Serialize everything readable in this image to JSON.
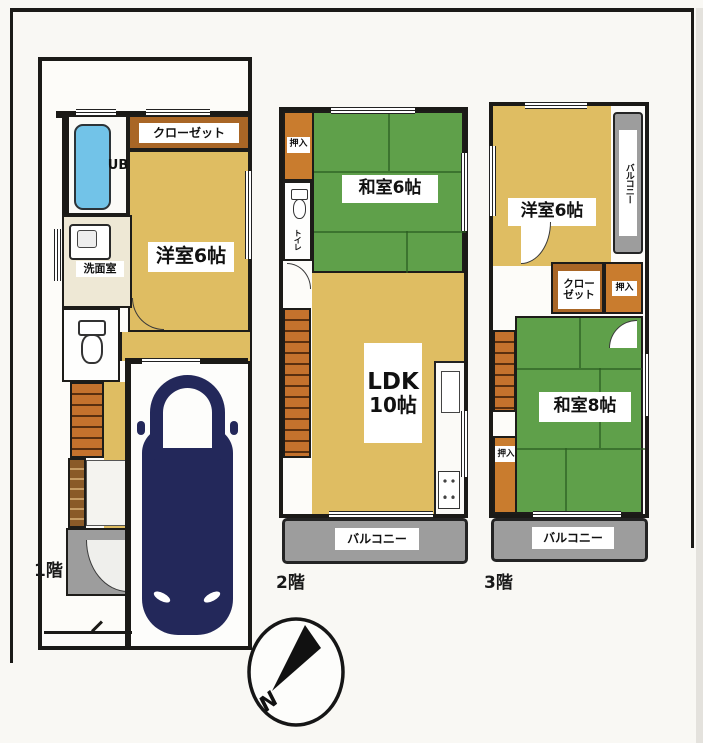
{
  "floor1": {
    "label": "1階",
    "closet": "クローゼット",
    "ub": "UB",
    "washroom": "洗面室",
    "western_room": "洋室6帖"
  },
  "floor2": {
    "label": "2階",
    "oshiire": "押入",
    "toilet": "トイレ",
    "japanese_room": "和室6帖",
    "ldk": "LDK",
    "ldk_size": "10帖",
    "balcony": "バルコニー"
  },
  "floor3": {
    "label": "3階",
    "western_room": "洋室6帖",
    "side_balcony": "バルコニー",
    "closet_line1": "クロー",
    "closet_line2": "ゼット",
    "oshiire_upper": "押入",
    "oshiire_lower": "押入",
    "japanese_room": "和室8帖",
    "balcony": "バルコニー"
  },
  "compass": {
    "north": "N"
  },
  "colors": {
    "wood_floor": "#dfbd62",
    "tatami_green": "#5fa04a",
    "stair_orange": "#c4722d",
    "oshiire_orange": "#c97c2e",
    "closet_brown": "#a96626",
    "balcony_gray": "#9d9d9d",
    "bath_blue": "#72c3e8",
    "car_navy": "#23285a",
    "wall_black": "#1b1a17"
  }
}
